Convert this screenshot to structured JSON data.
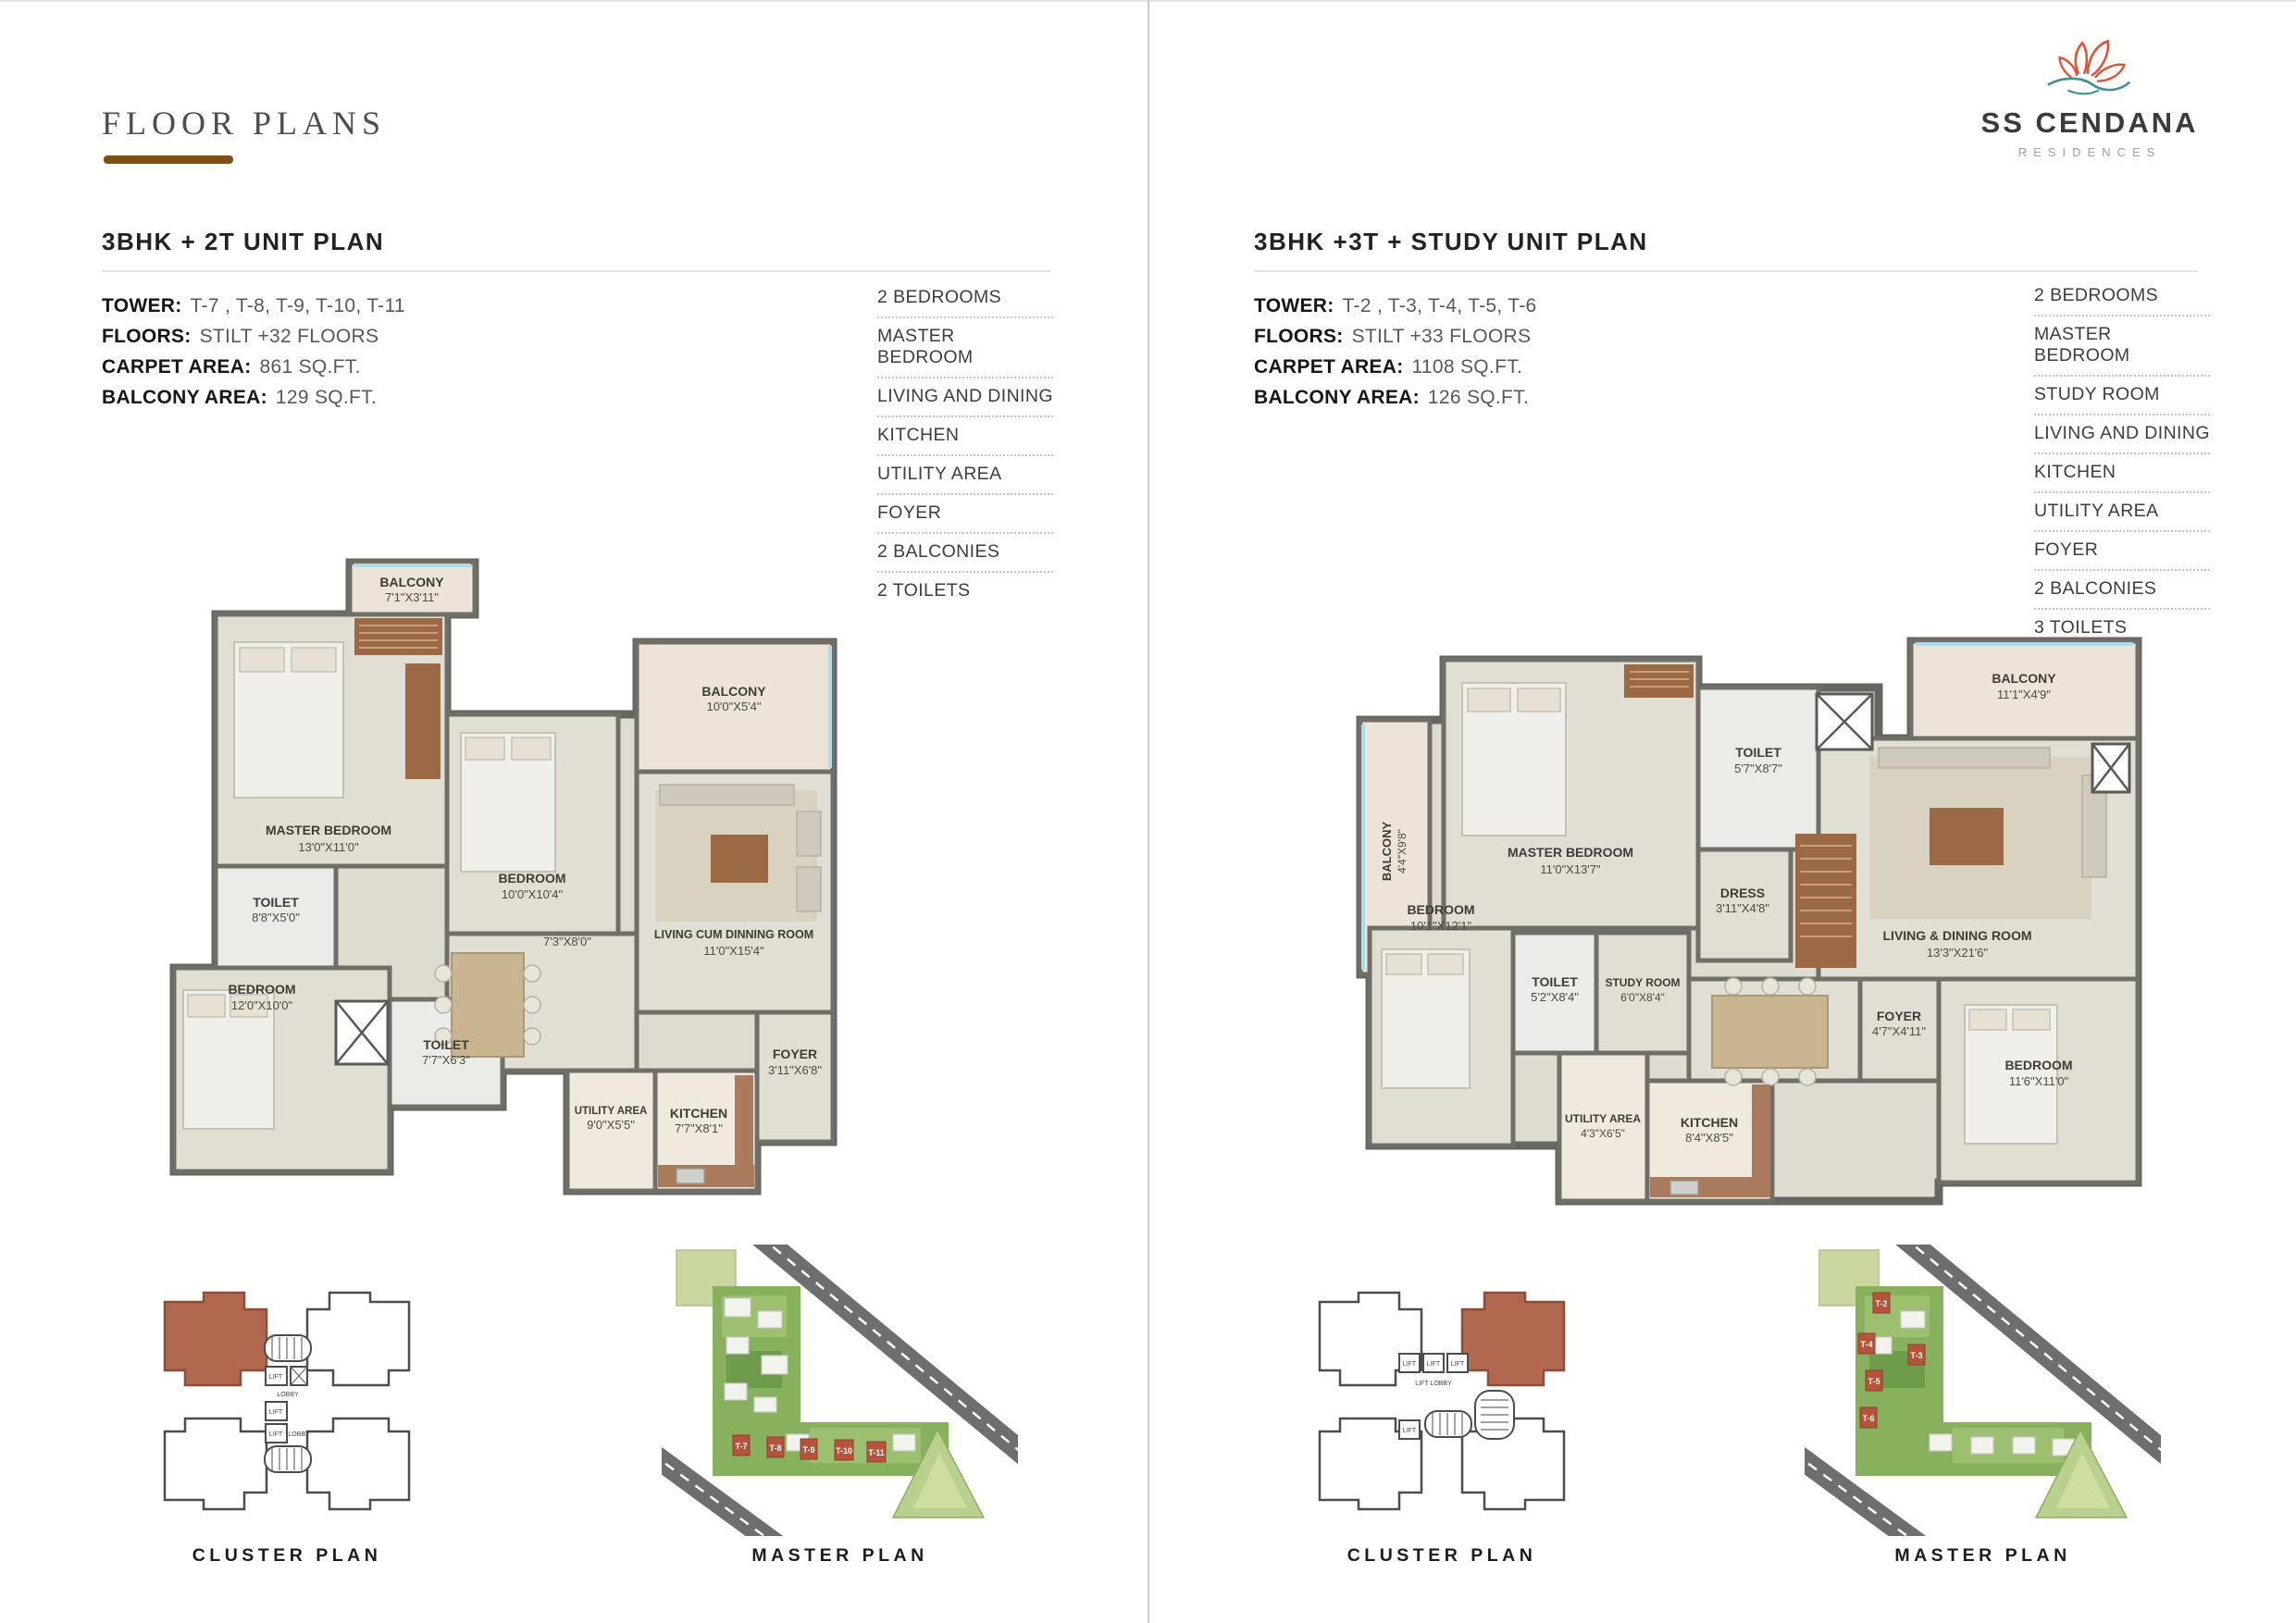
{
  "page_title": "FLOOR PLANS",
  "brand": {
    "name": "SS CENDANA",
    "tagline": "RESIDENCES"
  },
  "panels": [
    {
      "title": "3BHK + 2T UNIT PLAN",
      "specs": [
        {
          "label": "TOWER:",
          "value": "T-7 , T-8, T-9, T-10, T-11"
        },
        {
          "label": "FLOORS:",
          "value": "STILT +32  FLOORS"
        },
        {
          "label": "CARPET AREA:",
          "value": "861 SQ.FT."
        },
        {
          "label": "BALCONY AREA:",
          "value": "129 SQ.FT."
        }
      ],
      "features": [
        "2 BEDROOMS",
        "MASTER BEDROOM",
        "LIVING AND DINING",
        "KITCHEN",
        "UTILITY AREA",
        "FOYER",
        "2 BALCONIES",
        "2 TOILETS"
      ],
      "plan": {
        "labels": [
          {
            "name": "BALCONY",
            "dim": "7'1\"X3'11\""
          },
          {
            "name": "MASTER BEDROOM",
            "dim": "13'0\"X11'0\""
          },
          {
            "name": "TOILET",
            "dim": "8'8\"X5'0\""
          },
          {
            "name": "BEDROOM",
            "dim": "10'0\"X10'4\""
          },
          {
            "name": "BALCONY",
            "dim": "10'0\"X5'4\""
          },
          {
            "name": "",
            "dim": "7'3\"X8'0\""
          },
          {
            "name": "BEDROOM",
            "dim": "12'0\"X10'0\""
          },
          {
            "name": "TOILET",
            "dim": "7'7\"X6'3\""
          },
          {
            "name": "LIVING CUM DINNING ROOM",
            "dim": "11'0\"X15'4\""
          },
          {
            "name": "FOYER",
            "dim": "3'11\"X6'8\""
          },
          {
            "name": "UTILITY AREA",
            "dim": "9'0\"X5'5\""
          },
          {
            "name": "KITCHEN",
            "dim": "7'7\"X8'1\""
          }
        ]
      },
      "cluster": {
        "caption": "CLUSTER PLAN",
        "lift": "LIFT",
        "lobby": "LOBBY"
      },
      "master": {
        "caption": "MASTER PLAN",
        "towers": [
          "T-7",
          "T-8",
          "T-9",
          "T-10",
          "T-11"
        ]
      }
    },
    {
      "title": "3BHK +3T + STUDY UNIT PLAN",
      "specs": [
        {
          "label": "TOWER:",
          "value": "T-2 , T-3, T-4, T-5, T-6"
        },
        {
          "label": "FLOORS:",
          "value": "STILT +33  FLOORS"
        },
        {
          "label": "CARPET AREA:",
          "value": "1108 SQ.FT."
        },
        {
          "label": "BALCONY AREA:",
          "value": "126 SQ.FT."
        }
      ],
      "features": [
        "2 BEDROOMS",
        "MASTER BEDROOM",
        "STUDY ROOM",
        "LIVING AND DINING",
        "KITCHEN",
        "UTILITY AREA",
        "FOYER",
        "2 BALCONIES",
        "3 TOILETS"
      ],
      "plan": {
        "labels": [
          {
            "name": "BALCONY",
            "dim": "4'4\"X9'8\""
          },
          {
            "name": "MASTER BEDROOM",
            "dim": "11'0\"X13'7\""
          },
          {
            "name": "TOILET",
            "dim": "5'7\"X8'7\""
          },
          {
            "name": "DRESS",
            "dim": "3'11\"X4'8\""
          },
          {
            "name": "BALCONY",
            "dim": "11'1\"X4'9\""
          },
          {
            "name": "BEDROOM",
            "dim": "10'1\"X12'1\""
          },
          {
            "name": "LIVING & DINING ROOM",
            "dim": "13'3\"X21'6\""
          },
          {
            "name": "TOILET",
            "dim": "5'2\"X8'4\""
          },
          {
            "name": "STUDY ROOM",
            "dim": "6'0\"X8'4\""
          },
          {
            "name": "BEDROOM",
            "dim": "11'6\"X11'0\""
          },
          {
            "name": "UTILITY AREA",
            "dim": "4'3\"X6'5\""
          },
          {
            "name": "KITCHEN",
            "dim": "8'4\"X8'5\""
          },
          {
            "name": "FOYER",
            "dim": "4'7\"X4'11\""
          }
        ]
      },
      "cluster": {
        "caption": "CLUSTER PLAN",
        "lift": "LIFT",
        "lobby": "LIFT LOBBY"
      },
      "master": {
        "caption": "MASTER PLAN",
        "towers": [
          "T-2",
          "T-4",
          "T-3",
          "T-5",
          "T-6"
        ]
      }
    }
  ]
}
